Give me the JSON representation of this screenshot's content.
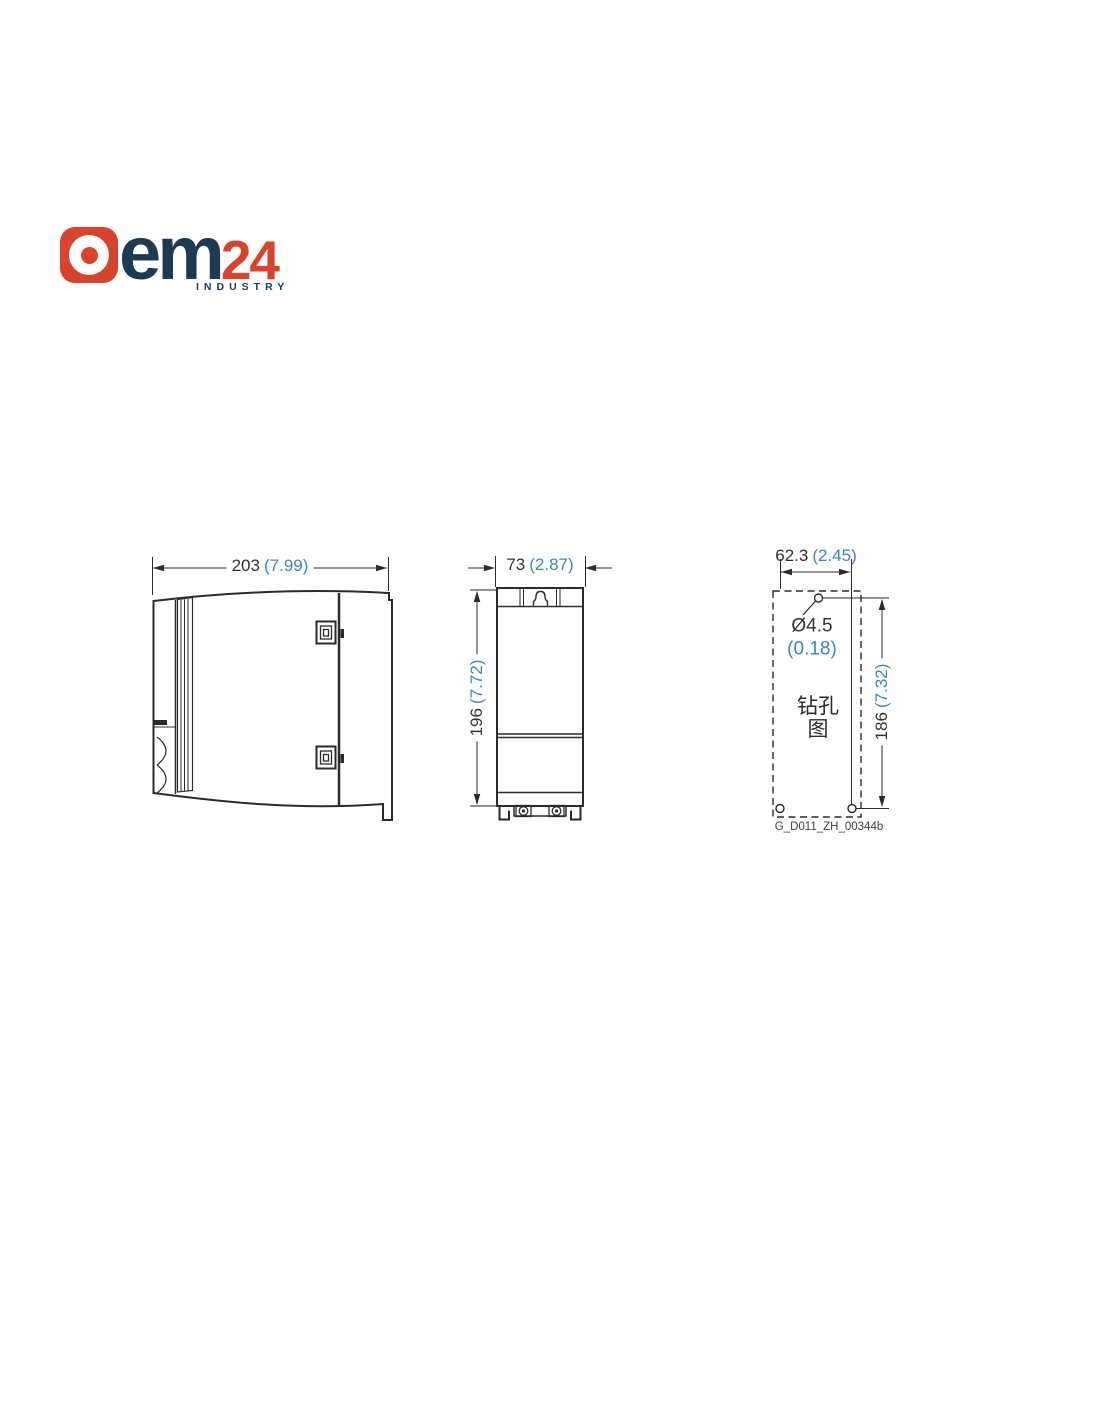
{
  "page": {
    "background": "#ffffff"
  },
  "logo": {
    "word_part1": "em",
    "word_part2": "24",
    "tagline": "INDUSTRY",
    "colors": {
      "red": "#D8432C",
      "navy": "#1D3A53"
    }
  },
  "diagram": {
    "line_color": "#2b2b2b",
    "mm_text_color": "#333333",
    "inch_text_color": "#3E87AE",
    "side_view": {
      "width_mm": "203",
      "width_inch": "(7.99)"
    },
    "front_view": {
      "width_mm": "73",
      "width_inch": "(2.87)",
      "height_mm": "196",
      "height_inch": "(7.72)"
    },
    "drill_view": {
      "width_mm": "62.3",
      "width_inch": "(2.45)",
      "height_mm": "186",
      "height_inch": "(7.32)",
      "hole_mm": "Ø4.5",
      "hole_inch": "(0.18)",
      "caption_line1": "钻孔",
      "caption_line2": "图",
      "figure_code": "G_D011_ZH_00344b"
    }
  }
}
